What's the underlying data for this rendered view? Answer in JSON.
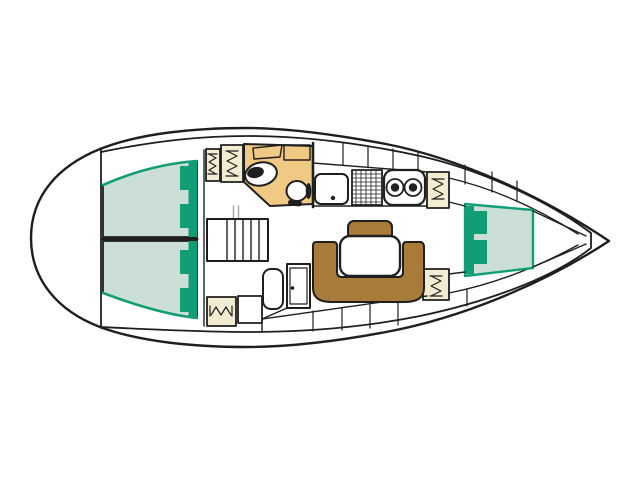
{
  "meta": {
    "description": "Top-down interior layout plan of a sailing yacht, bow pointing right. No text is rendered in the image.",
    "image_type": "boat-floorplan-diagram"
  },
  "colors": {
    "background": "#ffffff",
    "outline": "#1f1f1f",
    "hull_fill": "#ffffff",
    "berth_fill": "#cbdfd6",
    "berth_accent": "#119e77",
    "head_fill": "#f0ca84",
    "settee_fill": "#a87b3b",
    "locker_fill": "#f2ecd2",
    "fixture_fill": "#ffffff",
    "faint": "#aaaaaa"
  },
  "components": {
    "hull": {
      "label": "Hull and deck outline, rounded stern left, pointed bow right"
    },
    "aft_berth_top": {
      "label": "Aft double berth cabin (top side)"
    },
    "aft_berth_bottom": {
      "label": "Aft double berth cabin (bottom side)"
    },
    "v_berth": {
      "label": "Forward V-berth cabin"
    },
    "head": {
      "label": "Head compartment with toilet and washbasin"
    },
    "toilet": {
      "label": "Toilet"
    },
    "washbasin": {
      "label": "Washbasin"
    },
    "galley": {
      "label": "Galley with sink, stove and twin round sinks"
    },
    "galley_sink": {
      "label": "Galley sink with drain"
    },
    "stove": {
      "label": "Stove / grill grate"
    },
    "double_sink": {
      "label": "Twin round sinks unit"
    },
    "companionway": {
      "label": "Companionway steps"
    },
    "nav_station": {
      "label": "Navigation station"
    },
    "chart_table": {
      "label": "Chart table"
    },
    "nav_seat": {
      "label": "Navigator seat"
    },
    "nav_cabinet": {
      "label": "Cabinet below steps"
    },
    "settee": {
      "label": "U-shaped saloon settee"
    },
    "settee_backrest": {
      "label": "Settee end seat / backrest"
    },
    "saloon_table": {
      "label": "Saloon table"
    },
    "lockers": {
      "label": "Hanging lockers marked with zigzag symbol"
    },
    "shelves_top": {
      "label": "Side shelf lockers above galley"
    },
    "shelves_bottom": {
      "label": "Side shelf lockers behind settee"
    }
  }
}
